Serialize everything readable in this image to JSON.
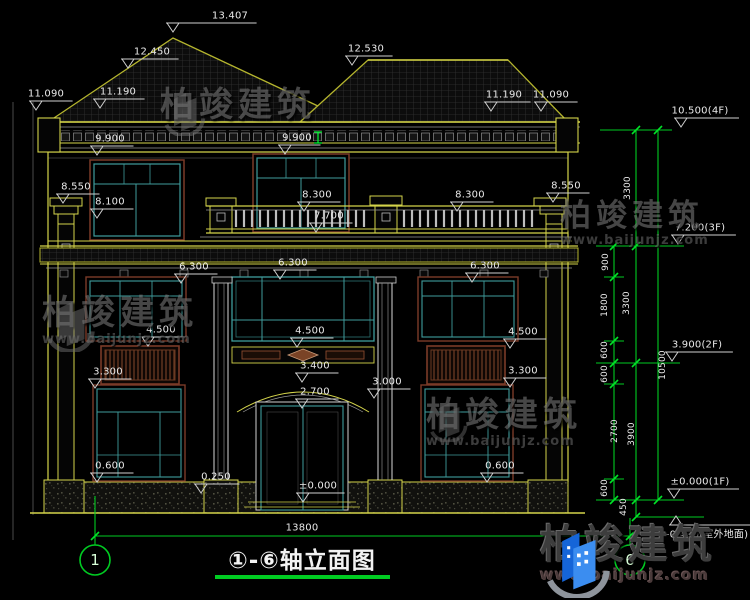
{
  "title_block": {
    "title": "①-⑥轴立面图",
    "axis_start": "1",
    "axis_end": "6"
  },
  "watermark": {
    "brand": "柏竣建筑",
    "url": "www.baijunjz.com"
  },
  "annotations": [
    {
      "t": "13.407",
      "x": 230,
      "y": 16,
      "mx": 173
    },
    {
      "t": "12.450",
      "x": 152,
      "y": 52,
      "mx": 128
    },
    {
      "t": "12.530",
      "x": 366,
      "y": 49,
      "mx": 352
    },
    {
      "t": "11.090",
      "x": 46,
      "y": 94,
      "mx": 36
    },
    {
      "t": "11.190",
      "x": 118,
      "y": 92,
      "mx": 100
    },
    {
      "t": "11.190",
      "x": 504,
      "y": 95,
      "mx": 491
    },
    {
      "t": "11.090",
      "x": 551,
      "y": 95,
      "mx": 541
    },
    {
      "t": "9.900",
      "x": 110,
      "y": 139,
      "mx": 97
    },
    {
      "t": "9.900",
      "x": 297,
      "y": 138,
      "mx": 285
    },
    {
      "t": "8.550",
      "x": 76,
      "y": 187,
      "mx": 63
    },
    {
      "t": "8.100",
      "x": 110,
      "y": 202,
      "mx": 97
    },
    {
      "t": "8.300",
      "x": 317,
      "y": 195,
      "mx": 304
    },
    {
      "t": "8.300",
      "x": 470,
      "y": 195,
      "mx": 457
    },
    {
      "t": "7.700",
      "x": 329,
      "y": 216,
      "mx": 316
    },
    {
      "t": "8.550",
      "x": 566,
      "y": 186,
      "mx": 553
    },
    {
      "t": "6.300",
      "x": 194,
      "y": 267,
      "mx": 181
    },
    {
      "t": "6.300",
      "x": 293,
      "y": 263,
      "mx": 280
    },
    {
      "t": "6.300",
      "x": 485,
      "y": 266,
      "mx": 472
    },
    {
      "t": "4.500",
      "x": 161,
      "y": 330,
      "mx": 148
    },
    {
      "t": "4.500",
      "x": 310,
      "y": 331,
      "mx": 297
    },
    {
      "t": "4.500",
      "x": 523,
      "y": 332,
      "mx": 510
    },
    {
      "t": "3.300",
      "x": 108,
      "y": 372,
      "mx": 95
    },
    {
      "t": "3.300",
      "x": 523,
      "y": 371,
      "mx": 510
    },
    {
      "t": "3.400",
      "x": 315,
      "y": 366,
      "mx": 302
    },
    {
      "t": "3.000",
      "x": 387,
      "y": 382,
      "mx": 374
    },
    {
      "t": "2.700",
      "x": 315,
      "y": 392,
      "mx": 302
    },
    {
      "t": "0.600",
      "x": 110,
      "y": 466,
      "mx": 97
    },
    {
      "t": "0.600",
      "x": 500,
      "y": 466,
      "mx": 487
    },
    {
      "t": "0.250",
      "x": 216,
      "y": 477,
      "mx": 201
    },
    {
      "t": "±0.000",
      "x": 318,
      "y": 486,
      "mx": 303
    },
    {
      "t": "10.500(4F)",
      "x": 700,
      "y": 111,
      "mx": 681
    },
    {
      "t": "7.200(3F)",
      "x": 700,
      "y": 228,
      "mx": 678
    },
    {
      "t": "3.900(2F)",
      "x": 697,
      "y": 345,
      "mx": 672
    },
    {
      "t": "±0.000(1F)",
      "x": 700,
      "y": 482,
      "mx": 674
    },
    {
      "t": "-0.450(室外地面)",
      "x": 707,
      "y": 533,
      "mx": 676,
      "up": 1
    },
    {
      "t": "13800",
      "x": 302,
      "y": 528
    },
    {
      "t": "3300",
      "x": 628,
      "y": 188,
      "r": 1
    },
    {
      "t": "900",
      "x": 606,
      "y": 262,
      "r": 1
    },
    {
      "t": "1800",
      "x": 605,
      "y": 305,
      "r": 1
    },
    {
      "t": "3300",
      "x": 627,
      "y": 303,
      "r": 1
    },
    {
      "t": "600",
      "x": 605,
      "y": 350,
      "r": 1
    },
    {
      "t": "600",
      "x": 605,
      "y": 374,
      "r": 1
    },
    {
      "t": "10500",
      "x": 663,
      "y": 365,
      "r": 1
    },
    {
      "t": "2700",
      "x": 615,
      "y": 431,
      "r": 1
    },
    {
      "t": "3900",
      "x": 632,
      "y": 434,
      "r": 1
    },
    {
      "t": "600",
      "x": 605,
      "y": 488,
      "r": 1
    },
    {
      "t": "450",
      "x": 624,
      "y": 507,
      "r": 1
    }
  ]
}
